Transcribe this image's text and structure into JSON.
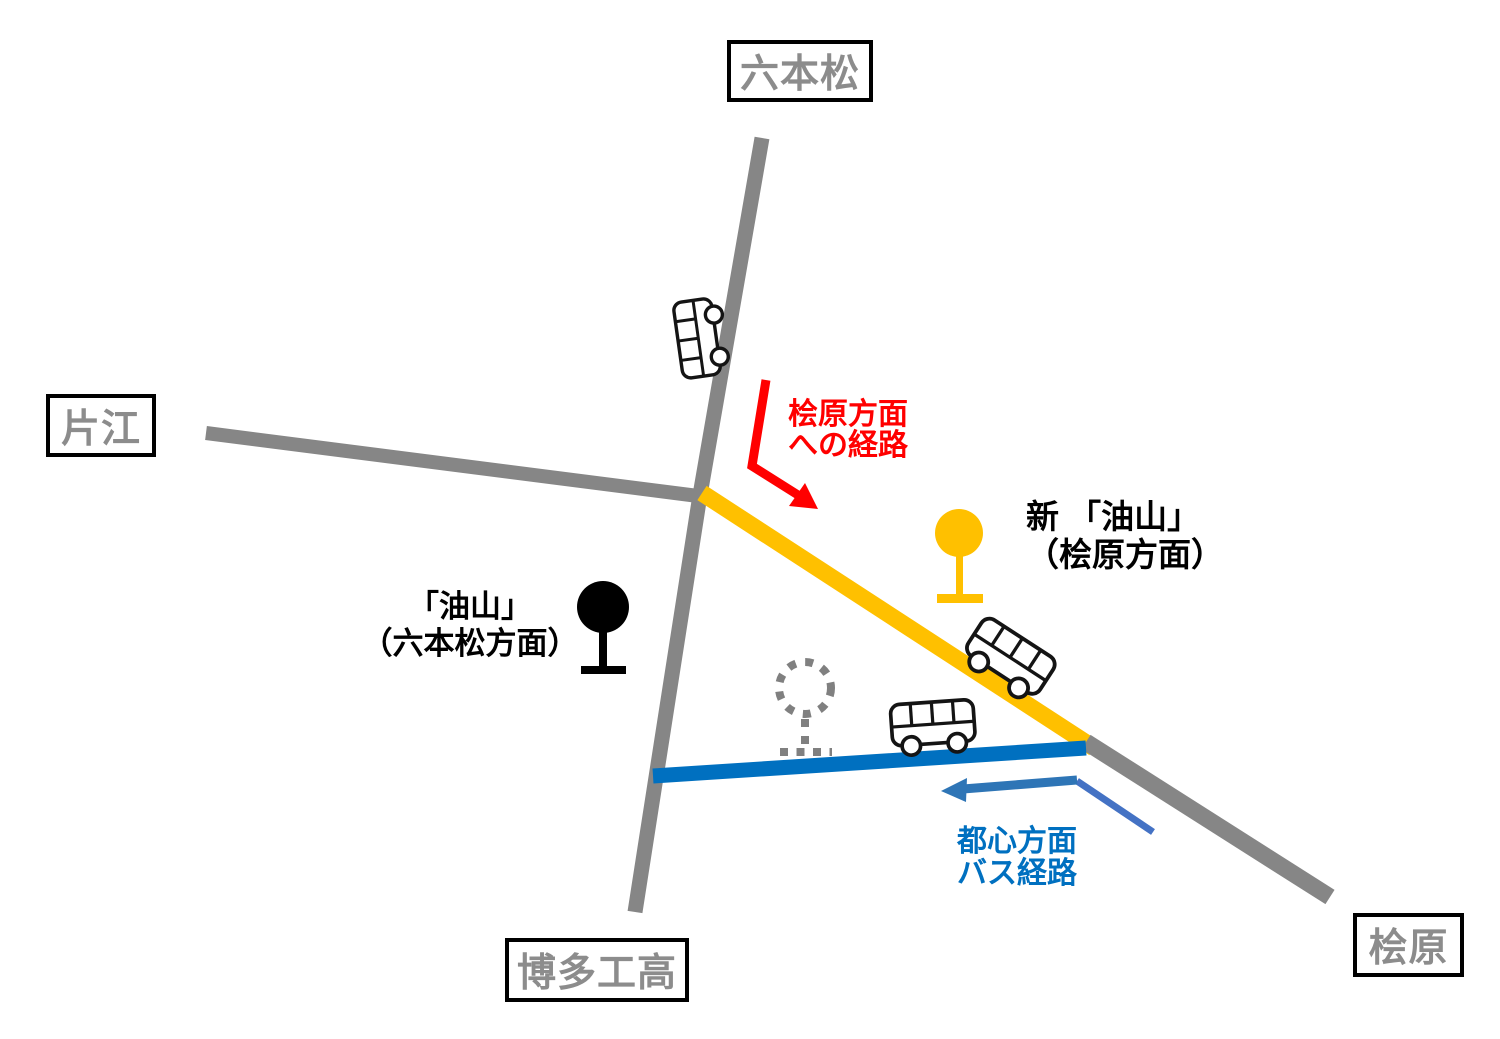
{
  "place_labels": {
    "north": "六本松",
    "west": "片江",
    "south": "博多工高",
    "southeast": "桧原"
  },
  "stops": {
    "current": {
      "line1": "「油山」",
      "line2": "（六本松方面）"
    },
    "new": {
      "line1": "新 「油山」",
      "line2": "（桧原方面）"
    }
  },
  "annotations": {
    "hibaru_route": {
      "line1": "桧原方面",
      "line2": "への経路"
    },
    "city_route": {
      "line1": "都心方面",
      "line2": "バス経路"
    }
  },
  "colors": {
    "road_gray": "#868686",
    "label_gray": "#8C8C8C",
    "route_yellow": "#FFC000",
    "route_blue": "#0070C0",
    "arrow_red": "#FF0000",
    "arrow_blue_dark": "#2E75B6",
    "arrow_blue_light": "#4472C4",
    "stop_black": "#000000",
    "dotted_gray": "#808080"
  }
}
